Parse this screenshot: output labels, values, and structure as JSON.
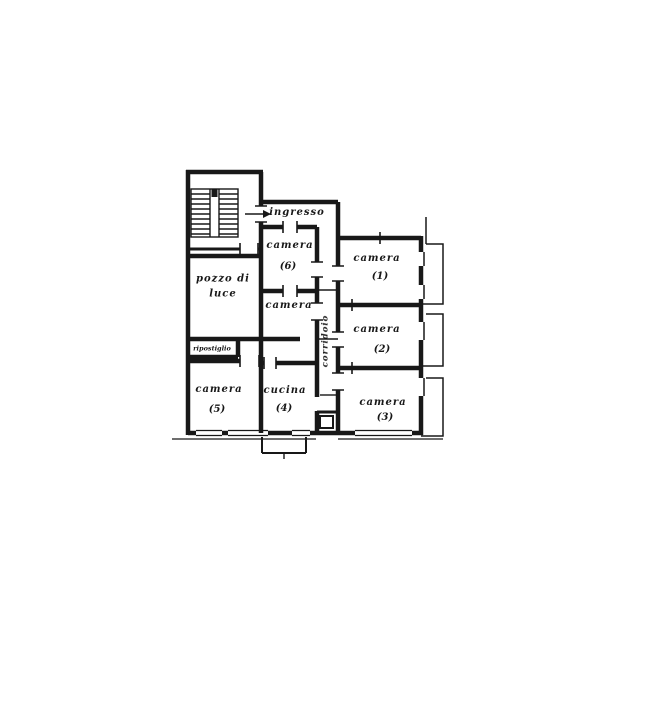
{
  "plan": {
    "entrance": {
      "label": "ingresso"
    },
    "corridor": {
      "label": "corridoio"
    },
    "light_well": {
      "line1": "pozzo di",
      "line2": "luce"
    },
    "storage": {
      "label": "ripostiglio"
    },
    "rooms": {
      "camera1": {
        "label": "camera",
        "number": "(1)"
      },
      "camera2": {
        "label": "camera",
        "number": "(2)"
      },
      "camera3": {
        "label": "camera",
        "number": "(3)"
      },
      "cucina4": {
        "label": "cucina",
        "number": "(4)"
      },
      "camera5": {
        "label": "camera",
        "number": "(5)"
      },
      "camera6": {
        "label": "camera",
        "number": "(6)"
      },
      "cameraSmall": {
        "label": "camera"
      }
    }
  }
}
